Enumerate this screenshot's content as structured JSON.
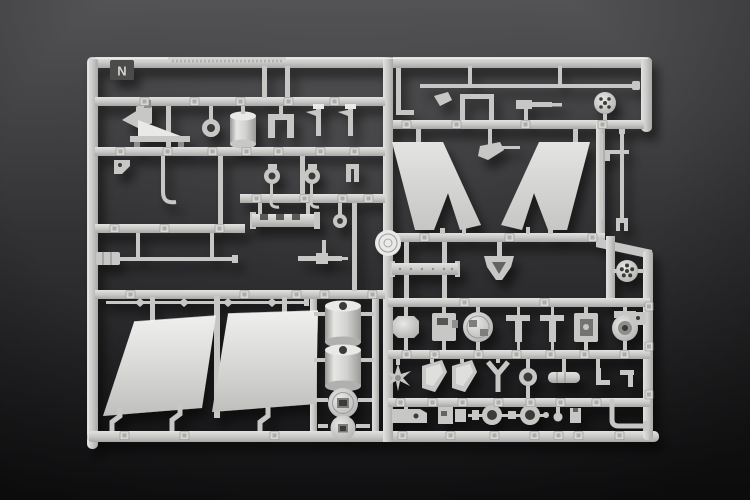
{
  "scene": {
    "description": "Photograph of a light gray injection-molded plastic model-kit sprue (parts runner) lying on a dark gray studio background, lit from the upper left.",
    "media": "photo",
    "subject": "model kit sprue with attached parts"
  },
  "sprue": {
    "letter": "N",
    "material": "light gray styrene plastic",
    "notable_parts": [
      "two large smooth hull/deck panels",
      "two large V-shaped bulwark blades",
      "two cylindrical funnel drums",
      "two round turret bases with rectangular slots",
      "perforated wheel disc",
      "mast rod with forked end",
      "gun barrel with muzzle brake",
      "railing rod with turnbuckle fittings",
      "cable reels, davits, hooks, brackets and assorted small fittings",
      "round embossed mold medallion"
    ]
  },
  "colors": {
    "bg_top": "#515153",
    "bg_mid": "#2d2d2f",
    "bg_bottom": "#18181a",
    "plastic": "#c7c7c5",
    "plastic_bright": "#e9e9e7",
    "plastic_mid": "#b4b4b2",
    "plastic_dark": "#8e8e8c",
    "tab_face": "#d6d6d4",
    "letter_tab": "#4b4b49",
    "letter_text": "#d3d3d1",
    "hole_dark": "#3a3a38",
    "shadow": "#000000"
  }
}
